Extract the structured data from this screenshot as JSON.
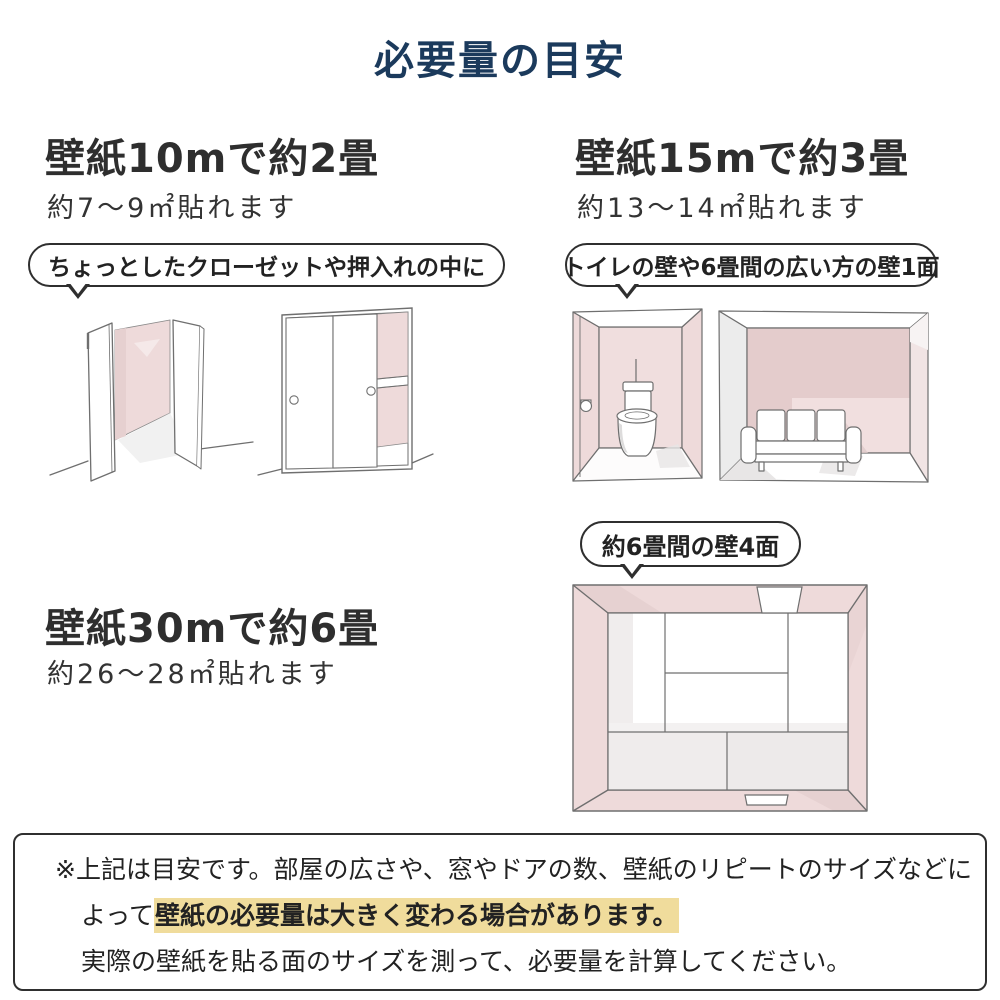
{
  "title": "必要量の目安",
  "sections": {
    "s10m": {
      "heading": "壁紙10mで約2畳",
      "subheading": "約7〜9㎡貼れます",
      "bubble": "ちょっとしたクローゼットや押入れの中に"
    },
    "s15m": {
      "heading": "壁紙15mで約3畳",
      "subheading": "約13〜14㎡貼れます",
      "bubble": "トイレの壁や6畳間の広い方の壁1面"
    },
    "s30m": {
      "heading": "壁紙30mで約6畳",
      "subheading": "約26〜28㎡貼れます",
      "bubble": "約6畳間の壁4面"
    }
  },
  "note": {
    "line1": "※上記は目安です。部屋の広さや、窓やドアの数、壁紙のリピートのサイズなどに",
    "line2_prefix": "よって",
    "line2_highlight": "壁紙の必要量は大きく変わる場合があります。",
    "line3": "実際の壁紙を貼る面のサイズを測って、必要量を計算してください。"
  },
  "illustrations": {
    "closet_open": "open-closet-illustration",
    "closet_sliding": "sliding-closet-illustration",
    "toilet": "toilet-room-illustration",
    "sofa_room": "sofa-room-illustration",
    "room_top": "room-top-view-illustration"
  },
  "colors": {
    "title_navy": "#1b3a5c",
    "text_dark": "#2f2f2f",
    "wall_pink": "#eedada",
    "wall_pink_dark": "#e4cccc",
    "wall_pink_light": "#f2e2e2",
    "wall_gray": "#ececec",
    "highlight_yellow": "#f0dc9c",
    "outline_gray": "#6f6f6f"
  }
}
